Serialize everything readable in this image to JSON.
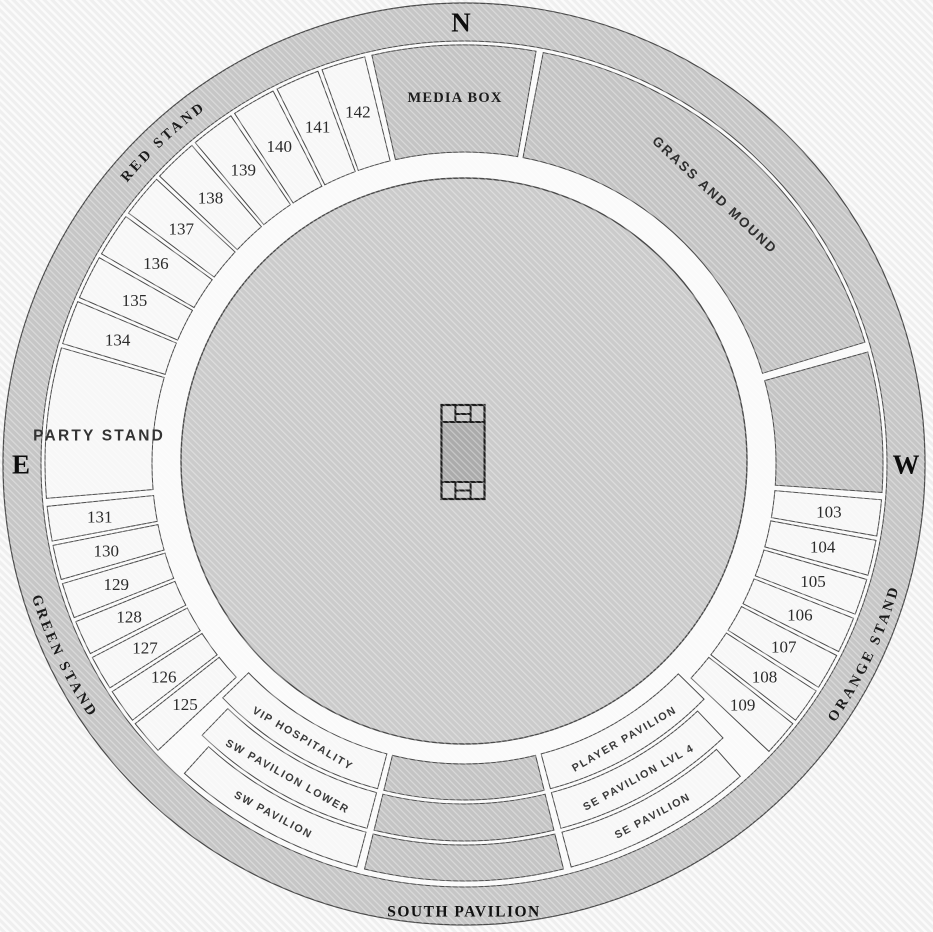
{
  "venue": {
    "compass": {
      "north": "N",
      "east": "E",
      "west": "W"
    },
    "colors": {
      "bg": "#f0f0f0",
      "ring": "#c6c6c6",
      "concourse": "#fafafa",
      "section_light": "#f7f7f7",
      "section_dark": "#c4c4c4",
      "field": "#cbcbcb",
      "pitch_center": "#ababab",
      "pitch_band": "#c7c7c7",
      "outline": "#4a4a4a",
      "pitch_outline": "#1c1c1c",
      "text_dark": "#1c1c1c"
    },
    "outer_stands": [
      {
        "id": "red-stand",
        "label": "RED STAND",
        "center": 317,
        "dir": "cw"
      },
      {
        "id": "green-stand",
        "label": "GREEN STAND",
        "center": 244.3,
        "dir": "ccw"
      },
      {
        "id": "orange-stand",
        "label": "ORANGE STAND",
        "center": 115.3,
        "dir": "ccw"
      },
      {
        "id": "south-pavilion",
        "label": "SOUTH PAVILION",
        "straight": true,
        "x": 464,
        "y": 911
      }
    ],
    "sections": [
      {
        "id": "media-box",
        "label": "MEDIA BOX",
        "a0": -13.0,
        "a1": 10.2,
        "r0": 312,
        "r1": 419,
        "tone": "dark",
        "style": "media",
        "label_r": 367,
        "label_a": -1.4
      },
      {
        "id": "grass-and-mound",
        "label": "GRASS AND MOUND",
        "a0": 10.6,
        "a1": 73.4,
        "r0": 312,
        "r1": 419,
        "tone": "dark",
        "style": "grass",
        "label_r": 368,
        "label_a": 43
      },
      {
        "id": "mound-west",
        "label": "",
        "a0": 74.2,
        "a1": 94.2,
        "r0": 312,
        "r1": 419,
        "tone": "dark"
      },
      {
        "id": "section-103",
        "label": "103",
        "a0": 94.6,
        "a1": 100.2,
        "r0": 312,
        "r1": 419,
        "tone": "light",
        "style": "num",
        "label_r": 368
      },
      {
        "id": "section-104",
        "label": "104",
        "a0": 100.2,
        "a1": 105.7,
        "r0": 312,
        "r1": 419,
        "tone": "light",
        "style": "num",
        "label_r": 368
      },
      {
        "id": "section-105",
        "label": "105",
        "a0": 105.7,
        "a1": 111.3,
        "r0": 312,
        "r1": 419,
        "tone": "light",
        "style": "num",
        "label_r": 368
      },
      {
        "id": "section-106",
        "label": "106",
        "a0": 111.3,
        "a1": 116.9,
        "r0": 312,
        "r1": 419,
        "tone": "light",
        "style": "num",
        "label_r": 368
      },
      {
        "id": "section-107",
        "label": "107",
        "a0": 116.9,
        "a1": 122.5,
        "r0": 312,
        "r1": 419,
        "tone": "light",
        "style": "num",
        "label_r": 368
      },
      {
        "id": "section-108",
        "label": "108",
        "a0": 122.5,
        "a1": 128.0,
        "r0": 312,
        "r1": 419,
        "tone": "light",
        "style": "num",
        "label_r": 368
      },
      {
        "id": "section-109",
        "label": "109",
        "a0": 128.0,
        "a1": 133.6,
        "r0": 312,
        "r1": 419,
        "tone": "light",
        "style": "num",
        "label_r": 368
      },
      {
        "id": "player-pavilion",
        "label": "PLAYER PAVILION",
        "a0": 134.1,
        "a1": 165.4,
        "r0": 300,
        "r1": 336,
        "tone": "light",
        "style": "band",
        "label_r": 318
      },
      {
        "id": "se-pavilion-lvl-4",
        "label": "SE PAVILION LVL 4",
        "a0": 136.3,
        "a1": 165.4,
        "r0": 340,
        "r1": 377,
        "tone": "light",
        "style": "band",
        "label_r": 358.5
      },
      {
        "id": "se-pavilion",
        "label": "SE PAVILION",
        "a0": 138.2,
        "a1": 165.4,
        "r0": 381,
        "r1": 417,
        "tone": "light",
        "style": "band",
        "label_r": 399
      },
      {
        "id": "south-arc-inner",
        "label": "",
        "a0": 165.9,
        "a1": 194.1,
        "r0": 300,
        "r1": 336,
        "tone": "dark"
      },
      {
        "id": "south-arc-middle",
        "label": "",
        "a0": 165.9,
        "a1": 194.1,
        "r0": 340,
        "r1": 377,
        "tone": "dark"
      },
      {
        "id": "south-arc-outer",
        "label": "",
        "a0": 165.9,
        "a1": 194.1,
        "r0": 381,
        "r1": 417,
        "tone": "dark"
      },
      {
        "id": "vip-hospitality",
        "label": "VIP HOSPITALITY",
        "a0": 194.6,
        "a1": 226.2,
        "r0": 300,
        "r1": 336,
        "tone": "light",
        "style": "band",
        "label_r": 318
      },
      {
        "id": "sw-pavilion-lower",
        "label": "SW PAVILION LOWER",
        "a0": 194.6,
        "a1": 224.3,
        "r0": 340,
        "r1": 377,
        "tone": "light",
        "style": "band",
        "label_r": 358.5
      },
      {
        "id": "sw-pavilion",
        "label": "SW PAVILION",
        "a0": 194.6,
        "a1": 222.4,
        "r0": 381,
        "r1": 417,
        "tone": "light",
        "style": "band",
        "label_r": 399
      },
      {
        "id": "section-125",
        "label": "125",
        "a0": 226.6,
        "a1": 232.0,
        "r0": 312,
        "r1": 419,
        "tone": "light",
        "style": "num",
        "label_r": 368
      },
      {
        "id": "section-126",
        "label": "126",
        "a0": 232.0,
        "a1": 237.4,
        "r0": 312,
        "r1": 419,
        "tone": "light",
        "style": "num",
        "label_r": 368
      },
      {
        "id": "section-127",
        "label": "127",
        "a0": 237.4,
        "a1": 242.8,
        "r0": 312,
        "r1": 419,
        "tone": "light",
        "style": "num",
        "label_r": 368
      },
      {
        "id": "section-128",
        "label": "128",
        "a0": 242.8,
        "a1": 248.2,
        "r0": 312,
        "r1": 419,
        "tone": "light",
        "style": "num",
        "label_r": 368
      },
      {
        "id": "section-129",
        "label": "129",
        "a0": 248.2,
        "a1": 253.7,
        "r0": 312,
        "r1": 419,
        "tone": "light",
        "style": "num",
        "label_r": 368
      },
      {
        "id": "section-130",
        "label": "130",
        "a0": 253.7,
        "a1": 259.1,
        "r0": 312,
        "r1": 419,
        "tone": "light",
        "style": "num",
        "label_r": 368
      },
      {
        "id": "section-131",
        "label": "131",
        "a0": 259.1,
        "a1": 264.5,
        "r0": 312,
        "r1": 419,
        "tone": "light",
        "style": "num",
        "label_r": 368
      },
      {
        "id": "party-stand",
        "label": "PARTY STAND",
        "a0": 265.0,
        "a1": 286.4,
        "r0": 312,
        "r1": 419,
        "tone": "light",
        "style": "party",
        "label_r": 366,
        "label_a": 274.5
      },
      {
        "id": "section-134",
        "label": "134",
        "a0": 286.4,
        "a1": 293.1,
        "r0": 312,
        "r1": 419,
        "tone": "light",
        "style": "num",
        "label_r": 368
      },
      {
        "id": "section-135",
        "label": "135",
        "a0": 293.1,
        "a1": 299.8,
        "r0": 312,
        "r1": 419,
        "tone": "light",
        "style": "num",
        "label_r": 368
      },
      {
        "id": "section-136",
        "label": "136",
        "a0": 299.8,
        "a1": 306.5,
        "r0": 312,
        "r1": 419,
        "tone": "light",
        "style": "num",
        "label_r": 368
      },
      {
        "id": "section-137",
        "label": "137",
        "a0": 306.5,
        "a1": 313.1,
        "r0": 312,
        "r1": 419,
        "tone": "light",
        "style": "num",
        "label_r": 368
      },
      {
        "id": "section-138",
        "label": "138",
        "a0": 313.1,
        "a1": 319.8,
        "r0": 312,
        "r1": 419,
        "tone": "light",
        "style": "num",
        "label_r": 368
      },
      {
        "id": "section-139",
        "label": "139",
        "a0": 319.8,
        "a1": 326.5,
        "r0": 312,
        "r1": 419,
        "tone": "light",
        "style": "num",
        "label_r": 368
      },
      {
        "id": "section-140",
        "label": "140",
        "a0": 326.5,
        "a1": 333.2,
        "r0": 312,
        "r1": 419,
        "tone": "light",
        "style": "num",
        "label_r": 368
      },
      {
        "id": "section-141",
        "label": "141",
        "a0": 333.2,
        "a1": 339.9,
        "r0": 312,
        "r1": 419,
        "tone": "light",
        "style": "num",
        "label_r": 368
      },
      {
        "id": "section-142",
        "label": "142",
        "a0": 339.9,
        "a1": 346.6,
        "r0": 312,
        "r1": 419,
        "tone": "light",
        "style": "num",
        "label_r": 368
      }
    ]
  }
}
